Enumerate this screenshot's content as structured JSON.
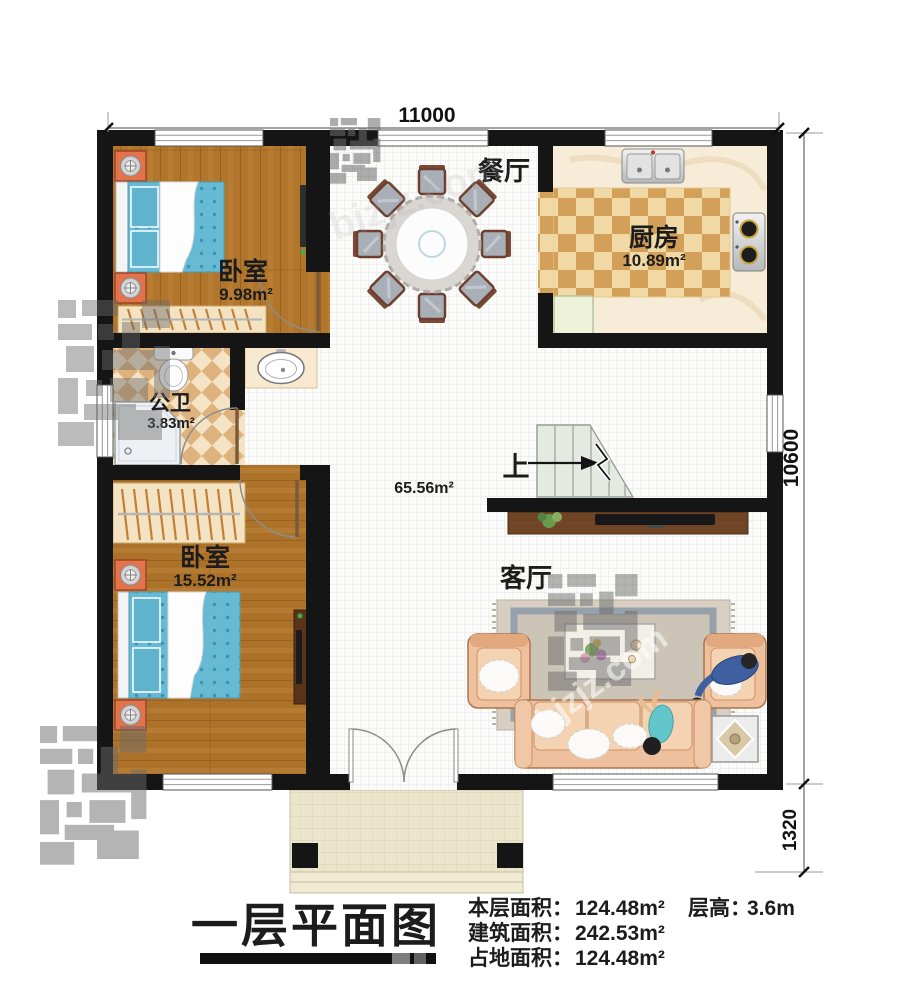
{
  "watermark": "bjzjz.com",
  "dimensions": {
    "width_top": "11000",
    "height_right": "10600",
    "porch_depth": "1320"
  },
  "rooms": {
    "bedroom1": {
      "name": "卧室",
      "area": "9.98m²"
    },
    "dining": {
      "name": "餐厅"
    },
    "kitchen": {
      "name": "厨房",
      "area": "10.89m²"
    },
    "bathroom": {
      "name": "公卫",
      "area": "3.83m²"
    },
    "bedroom2": {
      "name": "卧室",
      "area": "15.52m²"
    },
    "living": {
      "name": "客厅"
    },
    "hall": {
      "area": "65.56m²"
    },
    "stairs": {
      "label": "上"
    }
  },
  "footer": {
    "title": "一层平面图",
    "stats": [
      {
        "label": "本层面积：",
        "value": "124.48m²"
      },
      {
        "label": "建筑面积：",
        "value": "242.53m²"
      },
      {
        "label": "占地面积：",
        "value": "124.48m²"
      }
    ],
    "floor_height": {
      "label": "层高：",
      "value": "3.6m"
    }
  },
  "colors": {
    "wall": "#151515",
    "wood_floor": "#b1762b",
    "tile_dark": "#d2a058",
    "tile_light": "#f1d9a6",
    "bed_fabric": "#66bad3",
    "sofa_fabric": "#eec09e",
    "stair_fill": "#e4eae2",
    "porch_floor": "#ebe5cb",
    "text": "#1c1c1c"
  }
}
